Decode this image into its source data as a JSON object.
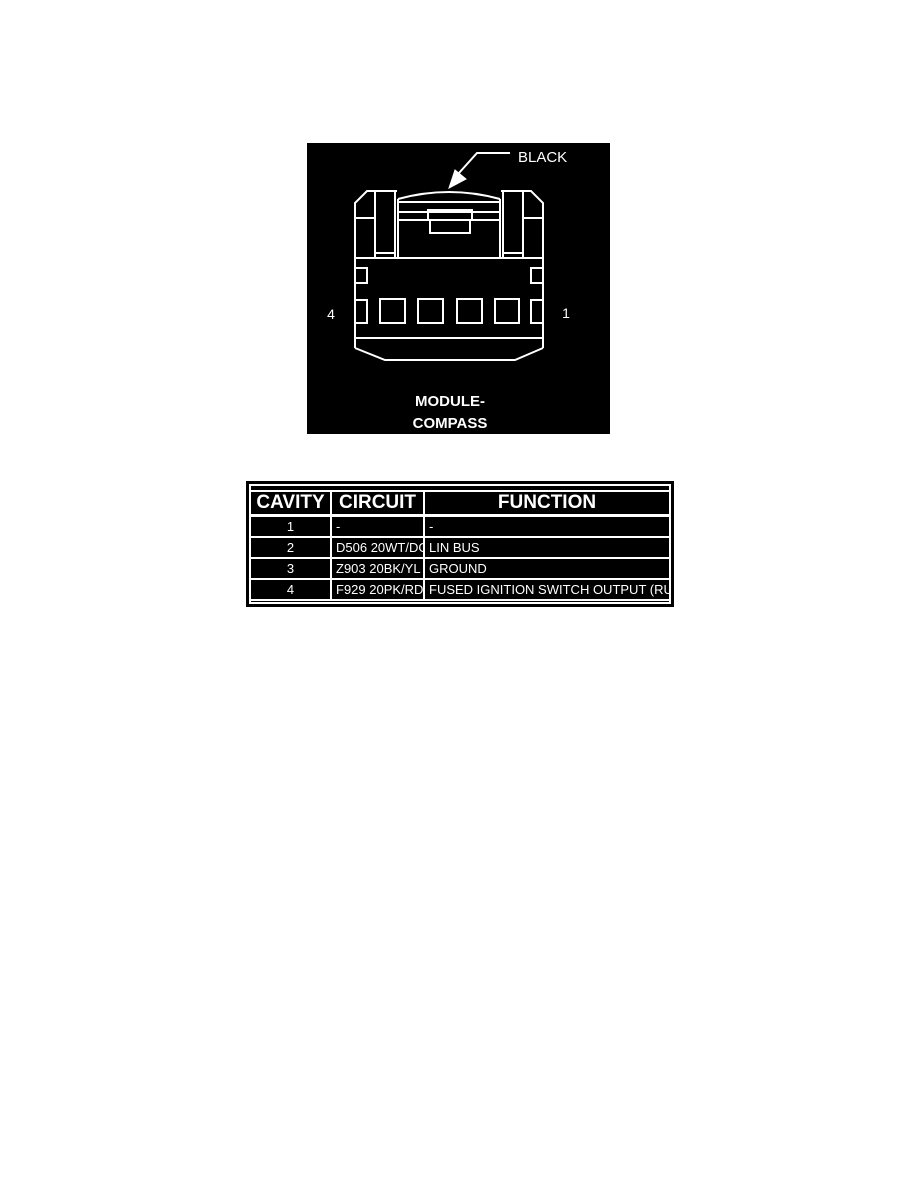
{
  "diagram": {
    "connector_color_label": "BLACK",
    "pin_label_left": "4",
    "pin_label_right": "1",
    "caption_line1": "MODULE-",
    "caption_line2": "COMPASS",
    "background_color": "#000000",
    "line_color": "#ffffff"
  },
  "pin_table": {
    "headers": [
      "CAVITY",
      "CIRCUIT",
      "FUNCTION"
    ],
    "rows": [
      {
        "cavity": "1",
        "circuit": "-",
        "function": "-"
      },
      {
        "cavity": "2",
        "circuit": "D506 20WT/DG",
        "function": "LIN BUS"
      },
      {
        "cavity": "3",
        "circuit": "Z903 20BK/YL",
        "function": "GROUND"
      },
      {
        "cavity": "4",
        "circuit": "F929 20PK/RD",
        "function": "FUSED IGNITION SWITCH OUTPUT (RUN)"
      }
    ]
  }
}
